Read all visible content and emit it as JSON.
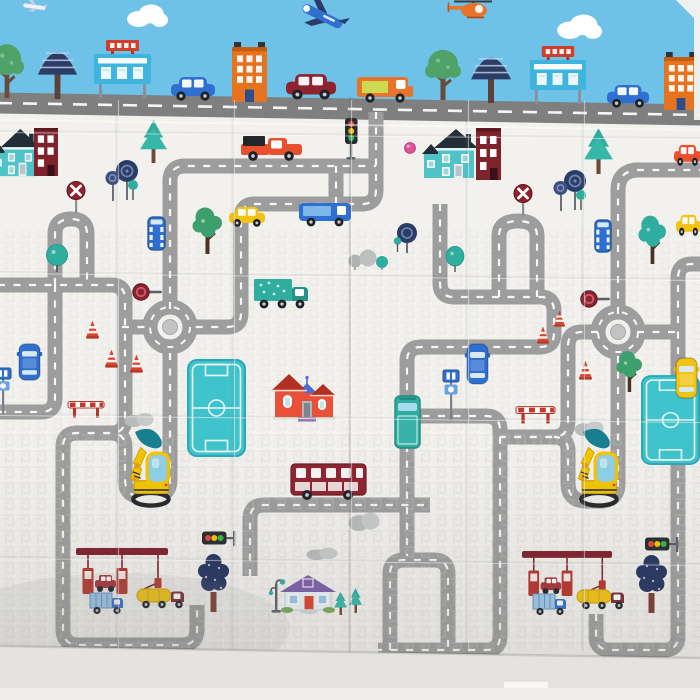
{
  "canvas": {
    "w": 700,
    "h": 700
  },
  "palette": {
    "sky": "#6ec2e8",
    "mat": "#f2f1ee",
    "roadMain": "#7f7f7f",
    "road": "#9d9d9d",
    "white": "#ffffff",
    "teal": "#2fae9f",
    "tealDark": "#177f8e",
    "tealBright": "#3fc3cc",
    "navy": "#2b3c66",
    "navyTree": "#24335f",
    "green": "#4fa26a",
    "red": "#d8442e",
    "maroon": "#8e2230",
    "wine": "#7e1f2b",
    "orange": "#e8731e",
    "orangeCar": "#e8502e",
    "yellow": "#f2c312",
    "yellowExc": "#f5c400",
    "blue": "#2f6fd0",
    "blueRoof": "#4a6cd4",
    "purple": "#7b5ea7",
    "purpleStep": "#8b6faf",
    "pink": "#e0559a",
    "dark": "#26292d",
    "steel": "#5a6068",
    "trunk": "#6b4a3a",
    "trunkRed": "#7a3b2e",
    "glass": "#8fd0e8",
    "limeCargo": "#cdd94e",
    "floor": "#e5e3df"
  },
  "sky": {
    "height": 110
  },
  "roads": [
    {
      "name": "main-street",
      "d": "M -2,103 L 702,115",
      "w": 21,
      "dash": "14 11"
    },
    {
      "name": "shelf-left",
      "d": "M 170,309 V 181 Q 170,166 185,166 H 376"
    },
    {
      "name": "fold-descent",
      "d": "M 376,112 V 190 Q 376,204 362,204 H 255 Q 241,204 241,218 V 313 Q 241,327 227,327 H 191"
    },
    {
      "name": "stub-junction",
      "d": "M 336,166 V 204"
    },
    {
      "name": "arch-left",
      "d": "M 55,285 V 234 Q 55,219 71,219 Q 87,219 87,234 V 285"
    },
    {
      "name": "left-exit",
      "d": "M 55,285 V 398 Q 55,412 41,412 H -2"
    },
    {
      "name": "long-left",
      "d": "M -2,285 H 111 Q 125,285 125,299 V 419 Q 125,433 111,433 H 77 Q 63,433 63,447 V 629 Q 63,645 79,645 H 181 Q 197,645 197,629 V 605"
    },
    {
      "name": "u-left",
      "d": "M 170,353 V 479 Q 170,497 152,497 H 143 Q 125,497 125,479 V 447 Q 125,433 111,433"
    },
    {
      "name": "roundabout-left-arm",
      "d": "M 122,327 H 150"
    },
    {
      "name": "bus-road",
      "d": "M 250,576 V 519 Q 250,505 264,505 H 430"
    },
    {
      "name": "fold-grid",
      "d": "M 440,204 V 283 Q 440,297 454,297 H 540 Q 554,297 554,311 V 333 Q 554,347 540,347 H 421 Q 407,347 407,361 V 556"
    },
    {
      "name": "arch-mid",
      "d": "M 499,297 V 236 Q 499,221 518,221 Q 537,221 537,236 V 297"
    },
    {
      "name": "n-center",
      "d": "M 407,416 H 486 Q 500,416 500,430 V 636 Q 500,650 486,650 H 378"
    },
    {
      "name": "arch-bottom",
      "d": "M 390,650 V 574 Q 390,560 404,560 H 434 Q 448,560 448,574 V 650"
    },
    {
      "name": "shelf-right",
      "d": "M 618,314 V 190 Q 618,172 636,170 H 702"
    },
    {
      "name": "roundabout-right-arm-left",
      "d": "M 598,332 H 582 Q 568,332 568,346 V 420 Q 568,437 554,437 H 500"
    },
    {
      "name": "u-right",
      "d": "M 618,356 V 483 Q 618,501 600,501 H 586 Q 568,501 568,483 V 451 Q 568,437 554,437"
    },
    {
      "name": "roundabout-right-arm-right",
      "d": "M 637,332 H 678"
    },
    {
      "name": "bottom-right-loop",
      "d": "M 596,614 V 636 Q 596,650 610,650 H 664 Q 678,650 678,636 V 278 Q 678,264 692,264 H 702"
    }
  ],
  "roundabouts": [
    {
      "cx": 170,
      "cy": 327
    },
    {
      "cx": 618,
      "cy": 332
    }
  ],
  "creases": {
    "vertical": [
      117,
      233,
      350,
      467,
      583
    ],
    "horizontal": [
      131,
      272,
      414,
      557
    ]
  },
  "floor": {
    "edge": "M -2,646 L 702,658 L 702,700 L -2,700 Z",
    "tab": {
      "x": 503,
      "y": 681,
      "w": 46,
      "h": 18
    }
  },
  "elements": [
    {
      "t": "cloud",
      "x": 126,
      "y": 4,
      "w": 42,
      "h": 24
    },
    {
      "t": "cloud",
      "x": 556,
      "y": 14,
      "w": 46,
      "h": 26
    },
    {
      "t": "plane_small",
      "x": 20,
      "y": 0,
      "w": 30,
      "h": 12
    },
    {
      "t": "plane",
      "x": 296,
      "y": 0,
      "w": 54,
      "h": 32
    },
    {
      "t": "helicopter",
      "x": 446,
      "y": 0,
      "w": 52,
      "h": 18
    },
    {
      "t": "tree_green",
      "x": -10,
      "y": 42,
      "w": 34,
      "h": 56
    },
    {
      "t": "tree_striped",
      "x": 36,
      "y": 40,
      "w": 43,
      "h": 59
    },
    {
      "t": "billboard",
      "x": 94,
      "y": 38,
      "w": 57,
      "h": 60
    },
    {
      "t": "car",
      "x": 171,
      "y": 76,
      "w": 44,
      "h": 26,
      "c": "#2f6fd0"
    },
    {
      "t": "building_orange",
      "x": 232,
      "y": 42,
      "w": 35,
      "h": 60
    },
    {
      "t": "car",
      "x": 286,
      "y": 73,
      "w": 50,
      "h": 28,
      "c": "#8e2230"
    },
    {
      "t": "van_orange",
      "x": 357,
      "y": 74,
      "w": 57,
      "h": 30
    },
    {
      "t": "tree_green",
      "x": 425,
      "y": 48,
      "w": 36,
      "h": 52
    },
    {
      "t": "tree_striped",
      "x": 469,
      "y": 46,
      "w": 44,
      "h": 57
    },
    {
      "t": "billboard",
      "x": 530,
      "y": 44,
      "w": 56,
      "h": 60
    },
    {
      "t": "car",
      "x": 607,
      "y": 84,
      "w": 42,
      "h": 25,
      "c": "#2f6fd0"
    },
    {
      "t": "building_orange",
      "x": 664,
      "y": 52,
      "w": 34,
      "h": 58
    },
    {
      "t": "field",
      "x": 188,
      "y": 360,
      "w": 57,
      "h": 96
    },
    {
      "t": "field",
      "x": 642,
      "y": 376,
      "w": 57,
      "h": 88
    },
    {
      "t": "traffic_light_v",
      "x": 343,
      "y": 118,
      "w": 16,
      "h": 44
    },
    {
      "t": "house_teal",
      "x": -8,
      "y": 126,
      "w": 46,
      "h": 54
    },
    {
      "t": "building_maroon",
      "x": 34,
      "y": 128,
      "w": 24,
      "h": 48
    },
    {
      "t": "no_entry",
      "x": 65,
      "y": 181,
      "w": 22,
      "h": 32
    },
    {
      "t": "lollipop",
      "x": 102,
      "y": 158,
      "w": 38,
      "h": 44
    },
    {
      "t": "tree_pine",
      "x": 140,
      "y": 120,
      "w": 27,
      "h": 43
    },
    {
      "t": "pickup",
      "x": 239,
      "y": 134,
      "w": 63,
      "h": 28
    },
    {
      "t": "car",
      "x": 674,
      "y": 144,
      "w": 27,
      "h": 23,
      "c": "#e8502e"
    },
    {
      "t": "pink_ball",
      "x": 404,
      "y": 142,
      "w": 12,
      "h": 12
    },
    {
      "t": "house_teal",
      "x": 424,
      "y": 126,
      "w": 52,
      "h": 56
    },
    {
      "t": "building_maroon",
      "x": 476,
      "y": 128,
      "w": 25,
      "h": 52
    },
    {
      "t": "lollipop",
      "x": 550,
      "y": 168,
      "w": 38,
      "h": 44
    },
    {
      "t": "tree_pine",
      "x": 584,
      "y": 128,
      "w": 29,
      "h": 46
    },
    {
      "t": "car",
      "x": 229,
      "y": 206,
      "w": 36,
      "h": 22,
      "c": "#f2c312"
    },
    {
      "t": "van_blue",
      "x": 299,
      "y": 201,
      "w": 52,
      "h": 27
    },
    {
      "t": "tree_leafy",
      "x": 192,
      "y": 204,
      "w": 30,
      "h": 50
    },
    {
      "t": "bus_top",
      "x": 146,
      "y": 216,
      "w": 21,
      "h": 35,
      "c": "#2f6fd0"
    },
    {
      "t": "bus_top",
      "x": 593,
      "y": 219,
      "w": 20,
      "h": 34,
      "c": "#2f6fd0"
    },
    {
      "t": "car",
      "x": 676,
      "y": 214,
      "w": 25,
      "h": 23,
      "c": "#f2c312"
    },
    {
      "t": "tree_leafy",
      "x": 638,
      "y": 212,
      "w": 28,
      "h": 52,
      "v": "teal"
    },
    {
      "t": "lollipop_single",
      "x": 393,
      "y": 222,
      "w": 28,
      "h": 32
    },
    {
      "t": "teal_ball",
      "x": 444,
      "y": 246,
      "w": 22,
      "h": 26
    },
    {
      "t": "bush_balls",
      "x": 348,
      "y": 248,
      "w": 42,
      "h": 22
    },
    {
      "t": "teal_ball",
      "x": 44,
      "y": 244,
      "w": 26,
      "h": 28
    },
    {
      "t": "no_entry",
      "x": 512,
      "y": 184,
      "w": 22,
      "h": 32
    },
    {
      "t": "ball_sign",
      "x": 132,
      "y": 282,
      "w": 32,
      "h": 20
    },
    {
      "t": "ball_sign",
      "x": 580,
      "y": 289,
      "w": 32,
      "h": 20
    },
    {
      "t": "truck_teal",
      "x": 254,
      "y": 278,
      "w": 56,
      "h": 33
    },
    {
      "t": "car_top",
      "x": 16,
      "y": 342,
      "w": 27,
      "h": 40,
      "c": "#2f6fd0"
    },
    {
      "t": "cone",
      "x": 86,
      "y": 320,
      "w": 13,
      "h": 19
    },
    {
      "t": "cone",
      "x": 105,
      "y": 349,
      "w": 13,
      "h": 19
    },
    {
      "t": "cone",
      "x": 130,
      "y": 354,
      "w": 13,
      "h": 19
    },
    {
      "t": "cone",
      "x": 537,
      "y": 326,
      "w": 12,
      "h": 18
    },
    {
      "t": "cone",
      "x": 554,
      "y": 310,
      "w": 11,
      "h": 17
    },
    {
      "t": "cone",
      "x": 579,
      "y": 360,
      "w": 13,
      "h": 20
    },
    {
      "t": "house_red",
      "x": 271,
      "y": 371,
      "w": 64,
      "h": 52
    },
    {
      "t": "barrier",
      "x": 68,
      "y": 399,
      "w": 36,
      "h": 19
    },
    {
      "t": "barrier",
      "x": 516,
      "y": 404,
      "w": 39,
      "h": 20
    },
    {
      "t": "bush_gray",
      "x": 124,
      "y": 411,
      "w": 30,
      "h": 16
    },
    {
      "t": "bush_gray",
      "x": 574,
      "y": 419,
      "w": 30,
      "h": 17
    },
    {
      "t": "tree_leafy",
      "x": 616,
      "y": 348,
      "w": 26,
      "h": 44
    },
    {
      "t": "excavator",
      "x": 122,
      "y": 428,
      "w": 56,
      "h": 80
    },
    {
      "t": "excavator",
      "x": 570,
      "y": 428,
      "w": 56,
      "h": 80
    },
    {
      "t": "car_top",
      "x": 464,
      "y": 342,
      "w": 27,
      "h": 44,
      "c": "#2f6fd0"
    },
    {
      "t": "bus_stop",
      "x": 440,
      "y": 370,
      "w": 22,
      "h": 50
    },
    {
      "t": "bus_stop",
      "x": -8,
      "y": 368,
      "w": 22,
      "h": 46
    },
    {
      "t": "truck_teal_top",
      "x": 392,
      "y": 395,
      "w": 31,
      "h": 56
    },
    {
      "t": "car_top",
      "x": 673,
      "y": 356,
      "w": 27,
      "h": 44,
      "c": "#f2c312"
    },
    {
      "t": "bush_gray",
      "x": 348,
      "y": 510,
      "w": 32,
      "h": 21
    },
    {
      "t": "bush_gray",
      "x": 306,
      "y": 546,
      "w": 32,
      "h": 14
    },
    {
      "t": "bus_red",
      "x": 291,
      "y": 462,
      "w": 77,
      "h": 39
    },
    {
      "t": "traffic_light_h",
      "x": 202,
      "y": 528,
      "w": 35,
      "h": 20
    },
    {
      "t": "traffic_light_h",
      "x": 645,
      "y": 534,
      "w": 35,
      "h": 20
    },
    {
      "t": "gas_station",
      "x": 76,
      "y": 548,
      "w": 96,
      "h": 46
    },
    {
      "t": "gas_station",
      "x": 522,
      "y": 551,
      "w": 94,
      "h": 45
    },
    {
      "t": "truck_blue",
      "x": 90,
      "y": 591,
      "w": 34,
      "h": 24
    },
    {
      "t": "tanker",
      "x": 137,
      "y": 584,
      "w": 52,
      "h": 26
    },
    {
      "t": "tree_navy",
      "x": 196,
      "y": 550,
      "w": 35,
      "h": 62
    },
    {
      "t": "truck_blue",
      "x": 533,
      "y": 592,
      "w": 34,
      "h": 24
    },
    {
      "t": "tanker",
      "x": 577,
      "y": 585,
      "w": 52,
      "h": 26
    },
    {
      "t": "tree_navy",
      "x": 634,
      "y": 551,
      "w": 35,
      "h": 62
    },
    {
      "t": "street_lamp",
      "x": 266,
      "y": 578,
      "w": 20,
      "h": 36
    },
    {
      "t": "house_blue",
      "x": 281,
      "y": 574,
      "w": 54,
      "h": 40
    },
    {
      "t": "tree_pine_s",
      "x": 334,
      "y": 592,
      "w": 13,
      "h": 23
    },
    {
      "t": "tree_pine_s",
      "x": 349,
      "y": 588,
      "w": 13,
      "h": 25
    }
  ]
}
